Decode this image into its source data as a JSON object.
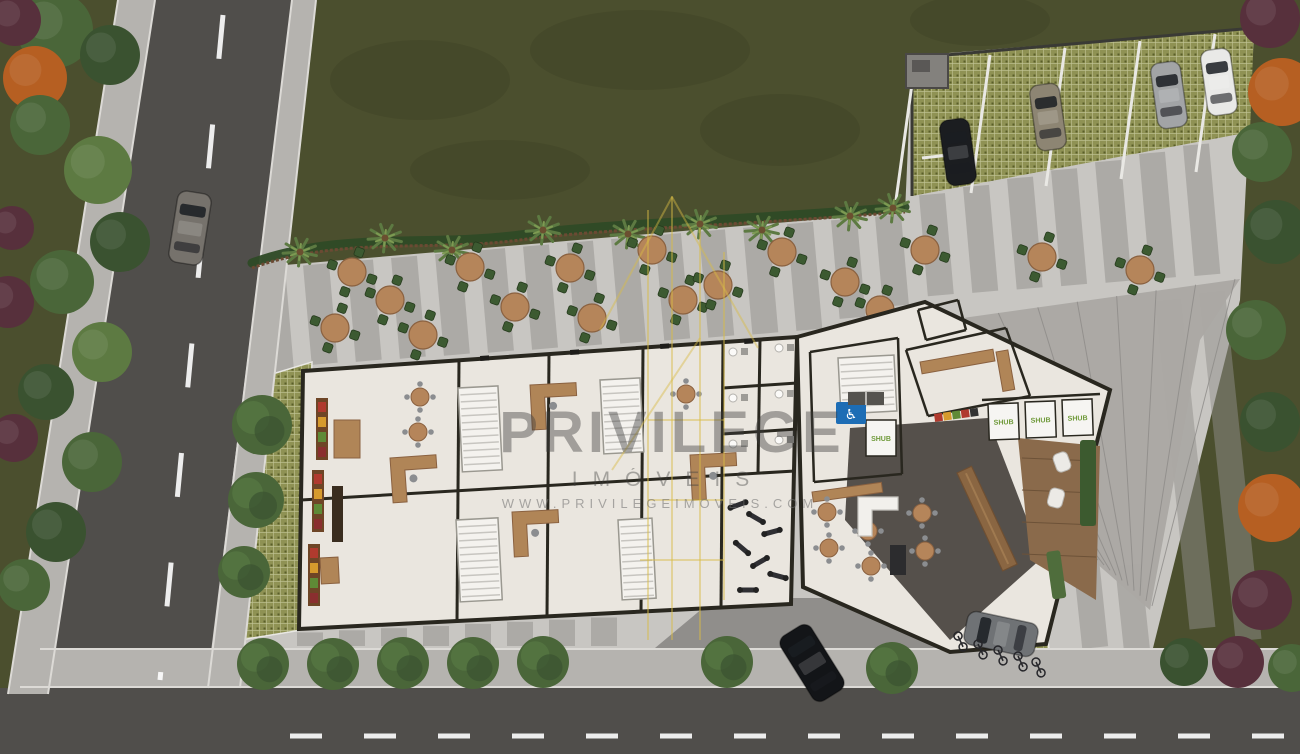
{
  "watermark": {
    "brand": "PRIVILEGE",
    "subtitle": "IMÓVEIS",
    "url": "WWW.PRIVILEGEIMOVEIS.COM",
    "text_color": "#3d3d3d",
    "logo_color": "#d9bc45",
    "logo": "building-outline-icon",
    "logo_lines": [
      [
        648,
        210,
        648,
        640
      ],
      [
        672,
        196,
        672,
        640
      ],
      [
        700,
        228,
        700,
        640
      ],
      [
        724,
        252,
        724,
        600
      ],
      [
        600,
        330,
        672,
        197
      ],
      [
        672,
        197,
        758,
        348
      ],
      [
        612,
        470,
        700,
        338
      ],
      [
        648,
        420,
        724,
        420
      ],
      [
        648,
        500,
        724,
        500
      ],
      [
        640,
        560,
        724,
        560
      ]
    ]
  },
  "signage": {
    "shub": "SHUB",
    "accessible": "♿"
  },
  "palette": {
    "grass": "#4b4f2e",
    "grass_dark": "#3c4023",
    "plaza": "#c8c6c2",
    "stripe": "#8f8d8a",
    "driveway": "#908e8b",
    "road": "#504e4b",
    "sidewalk": "#b5b3af",
    "curb": "#dcdad6",
    "white_line": "#e9e8e4",
    "paver": "#8f9254",
    "paver_line": "#c2c596",
    "paver_dot": "#5a5e2a",
    "wall": "#29271f",
    "floor": "#eae6df",
    "charcoal": "#55504b",
    "roof": "#aaa8a4",
    "roof_seam": "#8d8b88",
    "wood": "#b08557",
    "wood_dark": "#8a6642",
    "chair": "#3c5a31",
    "table_top": "#b5855a",
    "tree": "#4a6639",
    "tree_hi": "#557542",
    "tree_dark": "#3a5230",
    "palm": "#5d7a42",
    "palmc": "#5d7a42",
    "orange": "#b65f22",
    "burgundy": "#57303c",
    "fence": "#6b4a33",
    "planting": "#2e4a26",
    "deck": "#8a6a4b",
    "accent_blue": "#1d6db5",
    "shub_green": "#6f9a3a",
    "car_black": "#1b1d20",
    "car_beige": "#8d8573",
    "car_silver": "#a2a4a6",
    "car_white": "#e9e9e7",
    "car_gray": "#76726c",
    "car_black2": "#131518",
    "car_silver2": "#6f7275"
  },
  "scene": {
    "plaza": "250,268 905,212 912,56 1254,28 1240,300 1152,652 95,652",
    "driveway": "655,648 948,652 908,598 715,598",
    "ramp": "870,331 1240,279 1200,340 1150,610 1096,563 1100,392",
    "parking": {
      "quad": "912,58 1254,28 1250,132 912,196",
      "stalls": [
        [
          915,
          62
        ],
        [
          990,
          55
        ],
        [
          1065,
          48
        ],
        [
          1140,
          41
        ],
        [
          1215,
          34
        ]
      ],
      "structure": [
        906,
        54,
        42,
        34
      ],
      "cars": [
        [
          958,
          152,
          -8,
          "car_black"
        ],
        [
          1048,
          117,
          -8,
          "car_beige"
        ],
        [
          1169,
          95,
          -8,
          "car_silver"
        ],
        [
          1219,
          82,
          -8,
          "car_white"
        ]
      ]
    },
    "stripes": {
      "x0": 272,
      "step": 44,
      "count": 22,
      "rot": -5,
      "lengths": [
        300,
        210,
        330,
        180,
        300,
        240,
        330,
        200,
        280,
        320,
        190,
        300,
        230,
        320,
        260,
        180,
        300,
        220,
        340,
        200,
        280,
        240
      ],
      "extra": [
        [
          1168,
          300,
          330
        ],
        [
          1212,
          292,
          350
        ],
        [
          1086,
          560,
          88
        ],
        [
          1128,
          565,
          85
        ],
        [
          866,
          600,
          48
        ],
        [
          908,
          602,
          46
        ]
      ],
      "bottom": {
        "x0": 310,
        "step": 42,
        "count": 8
      }
    },
    "roads": {
      "bottomAsphalt": [
        0,
        688,
        1300,
        66
      ],
      "leftAsphalt": "155,0 292,0 205,700 40,700",
      "leftSideL": "118,0 155,0 48,694 8,694",
      "leftSideR": "292,0 316,0 240,688 208,688",
      "bottomSide": "40,648 1300,648 1300,688 20,688",
      "curbs": [
        [
          155,
          0,
          48,
          694
        ],
        [
          292,
          0,
          208,
          688
        ],
        [
          118,
          0,
          8,
          694
        ],
        [
          316,
          0,
          240,
          688
        ],
        [
          40,
          649,
          1300,
          649
        ],
        [
          20,
          687,
          1300,
          687
        ]
      ],
      "centerLeft": [
        223,
        15,
        160,
        680
      ],
      "centerBottom": [
        290,
        736,
        1300,
        736
      ]
    },
    "fence": "M252,268 C340,236 430,252 520,240 S700,228 905,212",
    "paverStrip": "246,382 312,362 302,630 228,642",
    "bikePatch": {
      "quad": "940,624 1046,618 1052,686 934,690",
      "bikes": [
        [
          958,
          636,
          -25
        ],
        [
          978,
          644,
          -25
        ],
        [
          998,
          650,
          -25
        ],
        [
          1018,
          656,
          -25
        ],
        [
          1036,
          662,
          -25
        ]
      ]
    },
    "tables": [
      [
        352,
        272
      ],
      [
        335,
        328
      ],
      [
        390,
        300
      ],
      [
        423,
        335
      ],
      [
        470,
        267
      ],
      [
        515,
        307
      ],
      [
        570,
        268
      ],
      [
        592,
        318
      ],
      [
        652,
        250
      ],
      [
        683,
        300
      ],
      [
        718,
        285
      ],
      [
        782,
        252
      ],
      [
        845,
        282
      ],
      [
        880,
        310
      ],
      [
        925,
        250
      ],
      [
        1042,
        257
      ],
      [
        1140,
        270
      ]
    ],
    "palms": [
      [
        300,
        252
      ],
      [
        385,
        238
      ],
      [
        452,
        250
      ],
      [
        543,
        230
      ],
      [
        628,
        234
      ],
      [
        700,
        224
      ],
      [
        762,
        230
      ],
      [
        850,
        216
      ],
      [
        893,
        208
      ]
    ],
    "treesStrip": [
      [
        262,
        425,
        30
      ],
      [
        256,
        500,
        28
      ],
      [
        244,
        572,
        26
      ]
    ],
    "treesBottom": [
      [
        263,
        664
      ],
      [
        333,
        664
      ],
      [
        403,
        663
      ],
      [
        473,
        663
      ],
      [
        543,
        662
      ],
      [
        727,
        662
      ],
      [
        892,
        668
      ]
    ],
    "vegLeft": [
      [
        55,
        30,
        38,
        "tree"
      ],
      [
        110,
        55,
        30,
        "tree_dark"
      ],
      [
        35,
        78,
        32,
        "orange"
      ],
      [
        15,
        20,
        26,
        "burgundy"
      ],
      [
        40,
        125,
        30,
        "tree"
      ],
      [
        98,
        170,
        34,
        "palmc"
      ],
      [
        12,
        228,
        22,
        "burgundy"
      ],
      [
        8,
        302,
        26,
        "burgundy"
      ],
      [
        120,
        242,
        30,
        "tree_dark"
      ],
      [
        62,
        282,
        32,
        "tree"
      ],
      [
        102,
        352,
        30,
        "palmc"
      ],
      [
        46,
        392,
        28,
        "tree_dark"
      ],
      [
        14,
        438,
        24,
        "burgundy"
      ],
      [
        92,
        462,
        30,
        "tree"
      ],
      [
        56,
        532,
        30,
        "tree_dark"
      ],
      [
        24,
        585,
        26,
        "tree"
      ]
    ],
    "vegRight": [
      [
        1270,
        18,
        30,
        "burgundy"
      ],
      [
        1282,
        92,
        34,
        "orange"
      ],
      [
        1262,
        152,
        30,
        "tree"
      ],
      [
        1276,
        232,
        32,
        "tree_dark"
      ],
      [
        1256,
        330,
        30,
        "tree"
      ],
      [
        1270,
        422,
        30,
        "tree_dark"
      ],
      [
        1272,
        508,
        34,
        "orange"
      ],
      [
        1262,
        600,
        30,
        "burgundy"
      ],
      [
        1238,
        662,
        26,
        "burgundy"
      ],
      [
        1184,
        662,
        24,
        "tree_dark"
      ],
      [
        1292,
        668,
        24,
        "tree"
      ]
    ],
    "grassPatches": [
      [
        420,
        80,
        90,
        40
      ],
      [
        640,
        50,
        110,
        40
      ],
      [
        780,
        130,
        80,
        36
      ],
      [
        500,
        170,
        90,
        30
      ],
      [
        980,
        20,
        70,
        26
      ]
    ],
    "carsOther": [
      [
        190,
        228,
        9,
        "car_gray",
        34,
        72
      ],
      [
        812,
        663,
        -32,
        "car_black2",
        36,
        76
      ],
      [
        1001,
        634,
        -78,
        "car_silver2",
        34,
        72
      ]
    ],
    "building": {
      "floor": "303,371 797,337 791,604 299,629",
      "wingFloor": "797,337 925,302 1110,390 1046,644 950,652 803,587",
      "charcoal": "850,428 988,418 1042,558 950,640 845,520",
      "walls": [
        [
          459,
          360,
          457,
          621
        ],
        [
          549,
          354,
          547,
          616
        ],
        [
          643,
          348,
          641,
          612
        ],
        [
          723,
          342,
          721,
          608
        ],
        [
          301,
          500,
          795,
          471
        ],
        [
          723,
          388,
          797,
          383
        ],
        [
          723,
          434,
          797,
          429
        ],
        [
          760,
          340,
          758,
          473
        ]
      ],
      "wingWalls": [
        [
          810,
          352,
          898,
          338
        ],
        [
          898,
          338,
          902,
          474
        ],
        [
          902,
          474,
          814,
          482
        ],
        [
          814,
          482,
          810,
          352
        ],
        [
          906,
          350,
          1006,
          328
        ],
        [
          1006,
          328,
          1030,
          396
        ],
        [
          1030,
          396,
          928,
          416
        ],
        [
          928,
          416,
          906,
          350
        ],
        [
          918,
          310,
          958,
          300
        ],
        [
          958,
          300,
          966,
          330
        ],
        [
          966,
          330,
          926,
          340
        ],
        [
          926,
          340,
          918,
          310
        ],
        [
          982,
          400,
          1100,
          394
        ]
      ],
      "stairs": [
        [
          458,
          388,
          40,
          84,
          -3
        ],
        [
          456,
          520,
          42,
          82,
          -3
        ],
        [
          600,
          380,
          40,
          74,
          -3
        ],
        [
          618,
          520,
          34,
          80,
          -3
        ],
        [
          838,
          358,
          56,
          56,
          -3
        ]
      ],
      "desks": [
        [
          390,
          458,
          -4
        ],
        [
          530,
          385,
          -3
        ],
        [
          512,
          512,
          -3
        ],
        [
          690,
          455,
          -3
        ]
      ],
      "woodRects": [
        [
          334,
          420,
          26,
          38,
          0
        ],
        [
          320,
          558,
          18,
          26,
          -3
        ],
        [
          920,
          362,
          74,
          12,
          -10
        ],
        [
          996,
          352,
          12,
          40,
          -10
        ],
        [
          812,
          492,
          70,
          10,
          -8
        ]
      ],
      "shelves": [
        [
          316,
          398
        ],
        [
          312,
          470
        ],
        [
          308,
          544
        ]
      ],
      "gondola": [
        332,
        486,
        11,
        56
      ],
      "indoorTables": [
        [
          420,
          397
        ],
        [
          418,
          432
        ],
        [
          686,
          394
        ],
        [
          827,
          512
        ],
        [
          829,
          548
        ],
        [
          868,
          531
        ],
        [
          922,
          513
        ],
        [
          925,
          551
        ],
        [
          871,
          566
        ]
      ],
      "gym": [
        [
          738,
          505,
          -20
        ],
        [
          756,
          518,
          30
        ],
        [
          772,
          532,
          -15
        ],
        [
          742,
          548,
          40
        ],
        [
          760,
          562,
          -30
        ],
        [
          778,
          576,
          15
        ],
        [
          748,
          590,
          0
        ]
      ],
      "fixtures": [
        [
          733,
          352
        ],
        [
          779,
          348
        ],
        [
          733,
          398
        ],
        [
          779,
          394
        ],
        [
          733,
          444
        ],
        [
          779,
          440
        ]
      ],
      "counterL": "M858,497 h40 v13 h-26 v26 h-14 z",
      "kiosk": [
        890,
        545,
        16,
        30
      ],
      "bar": [
        957,
        473,
        -25,
        16,
        108
      ],
      "deck": {
        "quad": "1018,438 1100,446 1096,600 1030,560",
        "chairs": [
          [
            1062,
            462,
            -20
          ],
          [
            1056,
            498,
            15
          ]
        ],
        "greenWall": [
          1080,
          440,
          16,
          86
        ],
        "couch": [
          1046,
          552,
          14,
          48,
          -8
        ]
      },
      "crates": [
        934,
        414
      ],
      "shubMats": [
        [
          988,
          404,
          -2
        ],
        [
          1025,
          402,
          -2
        ],
        [
          1062,
          400,
          -2
        ],
        [
          866,
          420,
          0
        ]
      ],
      "accessSign": [
        836,
        402,
        30,
        22
      ],
      "elevator": [
        848,
        392,
        36,
        13
      ],
      "ticks": [
        [
          480,
          356
        ],
        [
          570,
          350
        ],
        [
          660,
          344
        ],
        [
          744,
          339
        ]
      ]
    }
  }
}
